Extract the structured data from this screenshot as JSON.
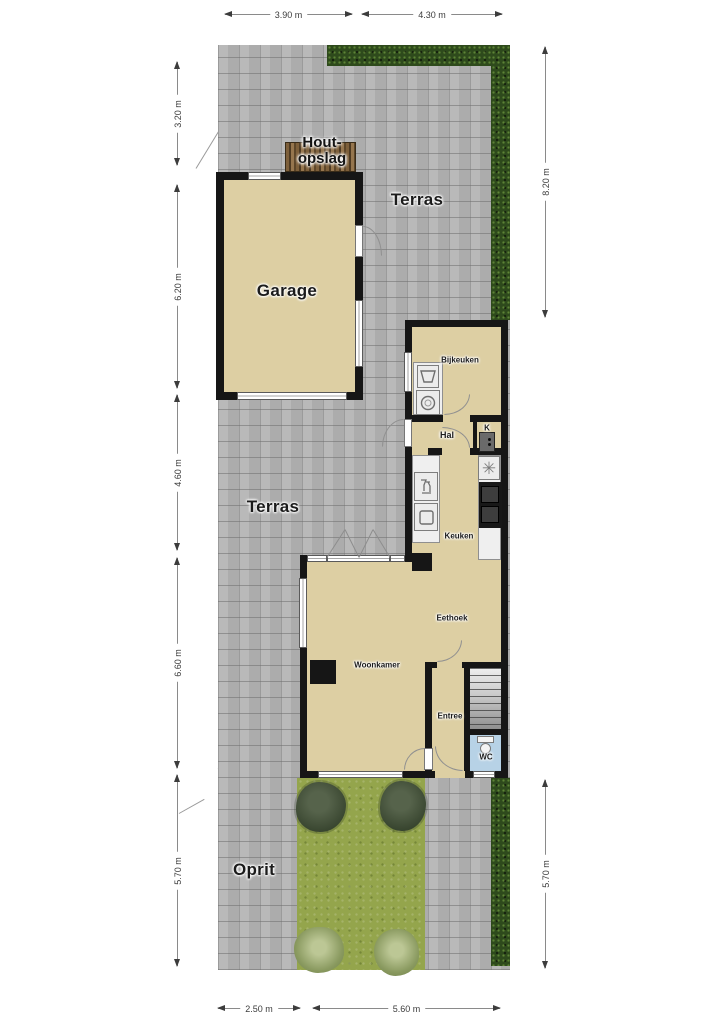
{
  "labels": {
    "houtopslag": {
      "line1": "Hout-",
      "line2": "opslag"
    },
    "terras_north": "Terras",
    "terras_west": "Terras",
    "garage": "Garage",
    "bijkeuken": "Bijkeuken",
    "hal": "Hal",
    "meterkast": "K",
    "keuken": "Keuken",
    "eethoek": "Eethoek",
    "woonkamer": "Woonkamer",
    "entree": "Entree",
    "wc": "WC",
    "oprit": "Oprit"
  },
  "dimensions": {
    "top": [
      {
        "label": "3.90 m"
      },
      {
        "label": "4.30 m"
      }
    ],
    "bottom": [
      {
        "label": "2.50 m"
      },
      {
        "label": "5.60 m"
      }
    ],
    "left": [
      {
        "label": "3.20 m"
      },
      {
        "label": "6.20 m"
      },
      {
        "label": "4.60 m"
      },
      {
        "label": "6.60 m"
      },
      {
        "label": "5.70 m"
      }
    ],
    "right": [
      {
        "label": "8.20 m"
      },
      {
        "label": "5.70 m"
      }
    ]
  },
  "icons": {
    "bijkeuken": [
      "laundry-sink-icon",
      "washing-machine-icon"
    ],
    "keuken": [
      "dishwasher-icon",
      "sink-icon",
      "extractor-fan-icon",
      "stove-icon"
    ],
    "meterkast": [
      "meter-box-icon"
    ],
    "wc": [
      "toilet-icon"
    ]
  },
  "glyphs": {
    "extractor_fan": "✳"
  },
  "colors": {
    "paving": "#b5b5b5",
    "floor": "#ddcfa3",
    "wall": "#161616",
    "grass": "#94a54c",
    "hedge": "#2e4a1c",
    "wc_floor": "#b7d2e6",
    "counter": "#efefef",
    "wood": "#7d5f3a",
    "stairs": "#c9c9c9",
    "dim_line": "#8a8a8a",
    "dim_text": "#3c3c3c"
  }
}
